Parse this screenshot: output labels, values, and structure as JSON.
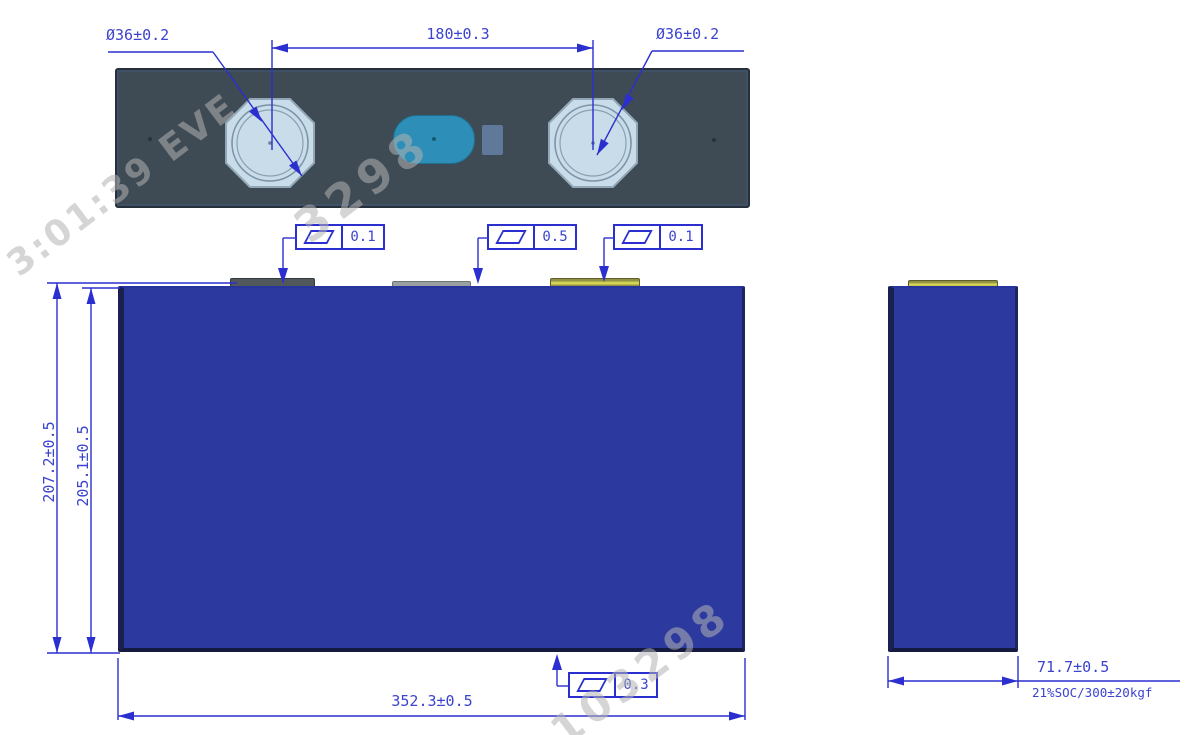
{
  "drawing": {
    "title": "prismatic-battery-cell-dimension-drawing",
    "top_view": {
      "terminal_left_diameter": "Ø36±0.2",
      "terminal_right_diameter": "Ø36±0.2",
      "terminal_pitch": "180±0.3"
    },
    "flatness_callouts": {
      "top_left": "0.1",
      "top_center": "0.5",
      "top_right": "0.1",
      "bottom": "0.3"
    },
    "front_view": {
      "height_overall": "207.2±0.5",
      "height_case": "205.1±0.5",
      "width": "352.3±0.5"
    },
    "side_view": {
      "thickness": "71.7±0.5",
      "measure_condition": "21%SOC/300±20kgf"
    },
    "watermarks": {
      "fragment_top_left": "3:01:39 EVE",
      "fragment_top_center": "3298",
      "fragment_bottom_right": "103298"
    },
    "colors": {
      "annotation_blue": "#2b2fd0",
      "annotation_text_blue": "#3b43cf",
      "cell_body_blue": "#2c3a9f",
      "top_cover_gray": "#3e4b55",
      "terminal_pad_blue": "#c9dcea",
      "vent_teal": "#2d8fb7",
      "marker_square_gray": "#60789a",
      "terminal_strip_olive": "#d6d654"
    }
  }
}
